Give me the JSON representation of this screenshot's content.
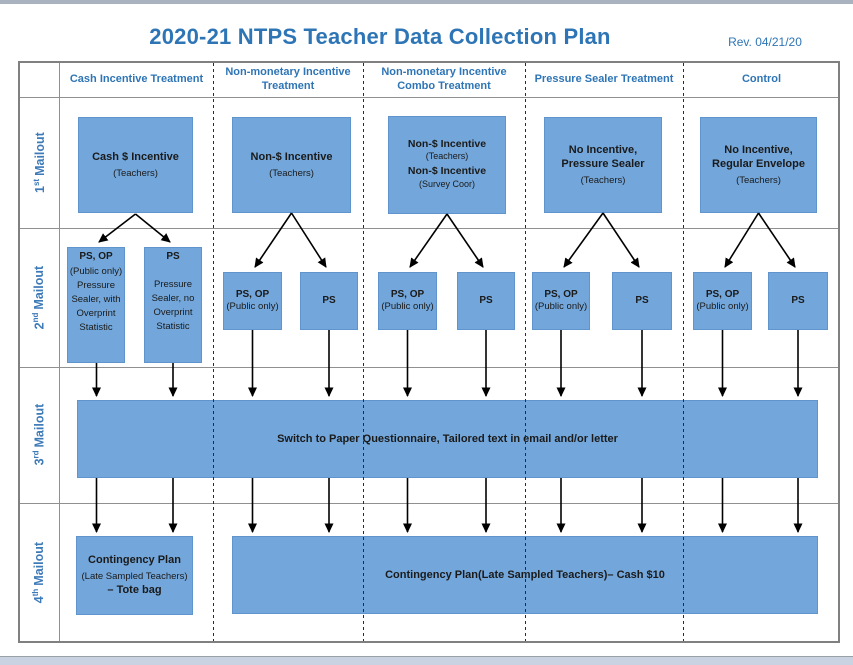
{
  "page": {
    "title": "2020-21 NTPS Teacher Data Collection Plan",
    "revision": "Rev. 04/21/20",
    "colors": {
      "accent_blue": "#2E75B6",
      "box_fill": "#73A7DB",
      "row_label_blue": "#3D7AB8",
      "top_strip": "#A9B2BF",
      "bottom_strip": "#C8D2E0"
    }
  },
  "columns": [
    {
      "label": "Cash Incentive Treatment"
    },
    {
      "label": "Non-monetary Incentive Treatment"
    },
    {
      "label": "Non-monetary Incentive Combo Treatment"
    },
    {
      "label": "Pressure Sealer Treatment"
    },
    {
      "label": "Control"
    }
  ],
  "row_labels": [
    {
      "num": "1",
      "ord": "st",
      "word": "Mailout"
    },
    {
      "num": "2",
      "ord": "nd",
      "word": "Mailout"
    },
    {
      "num": "3",
      "ord": "rd",
      "word": "Mailout"
    },
    {
      "num": "4",
      "ord": "th",
      "word": "Mailout"
    }
  ],
  "mailout1": {
    "cash": {
      "title": "Cash $ Incentive",
      "sub": "(Teachers)"
    },
    "non_monetary": {
      "title": "Non-$ Incentive",
      "sub": "(Teachers)"
    },
    "combo": {
      "title1": "Non-$ Incentive",
      "sub1": "(Teachers)",
      "title2": "Non-$ Incentive",
      "sub2": "(Survey Coor)"
    },
    "pressure_sealer": {
      "title": "No Incentive, Pressure Sealer",
      "sub": "(Teachers)"
    },
    "control": {
      "title": "No Incentive, Regular Envelope",
      "sub": "(Teachers)"
    }
  },
  "mailout2": {
    "cash_left": {
      "title": "PS, OP",
      "sub": "(Public only)",
      "desc": "Pressure Sealer, with Overprint Statistic"
    },
    "cash_right": {
      "title": "PS",
      "desc": "Pressure Sealer, no Overprint Statistic"
    },
    "ps_op_box": {
      "title": "PS, OP",
      "sub": "(Public only)"
    },
    "ps_box": {
      "title": "PS"
    }
  },
  "mailout3": {
    "banner": "Switch to Paper Questionnaire, Tailored text in email and/or letter"
  },
  "mailout4": {
    "cash": {
      "title": "Contingency Plan",
      "sub": "(Late Sampled Teachers)",
      "detail": "– Tote bag"
    },
    "banner": {
      "bold1": "Contingency Plan",
      "sub": "(Late Sampled Teachers)",
      "bold2": "– Cash $10"
    }
  }
}
